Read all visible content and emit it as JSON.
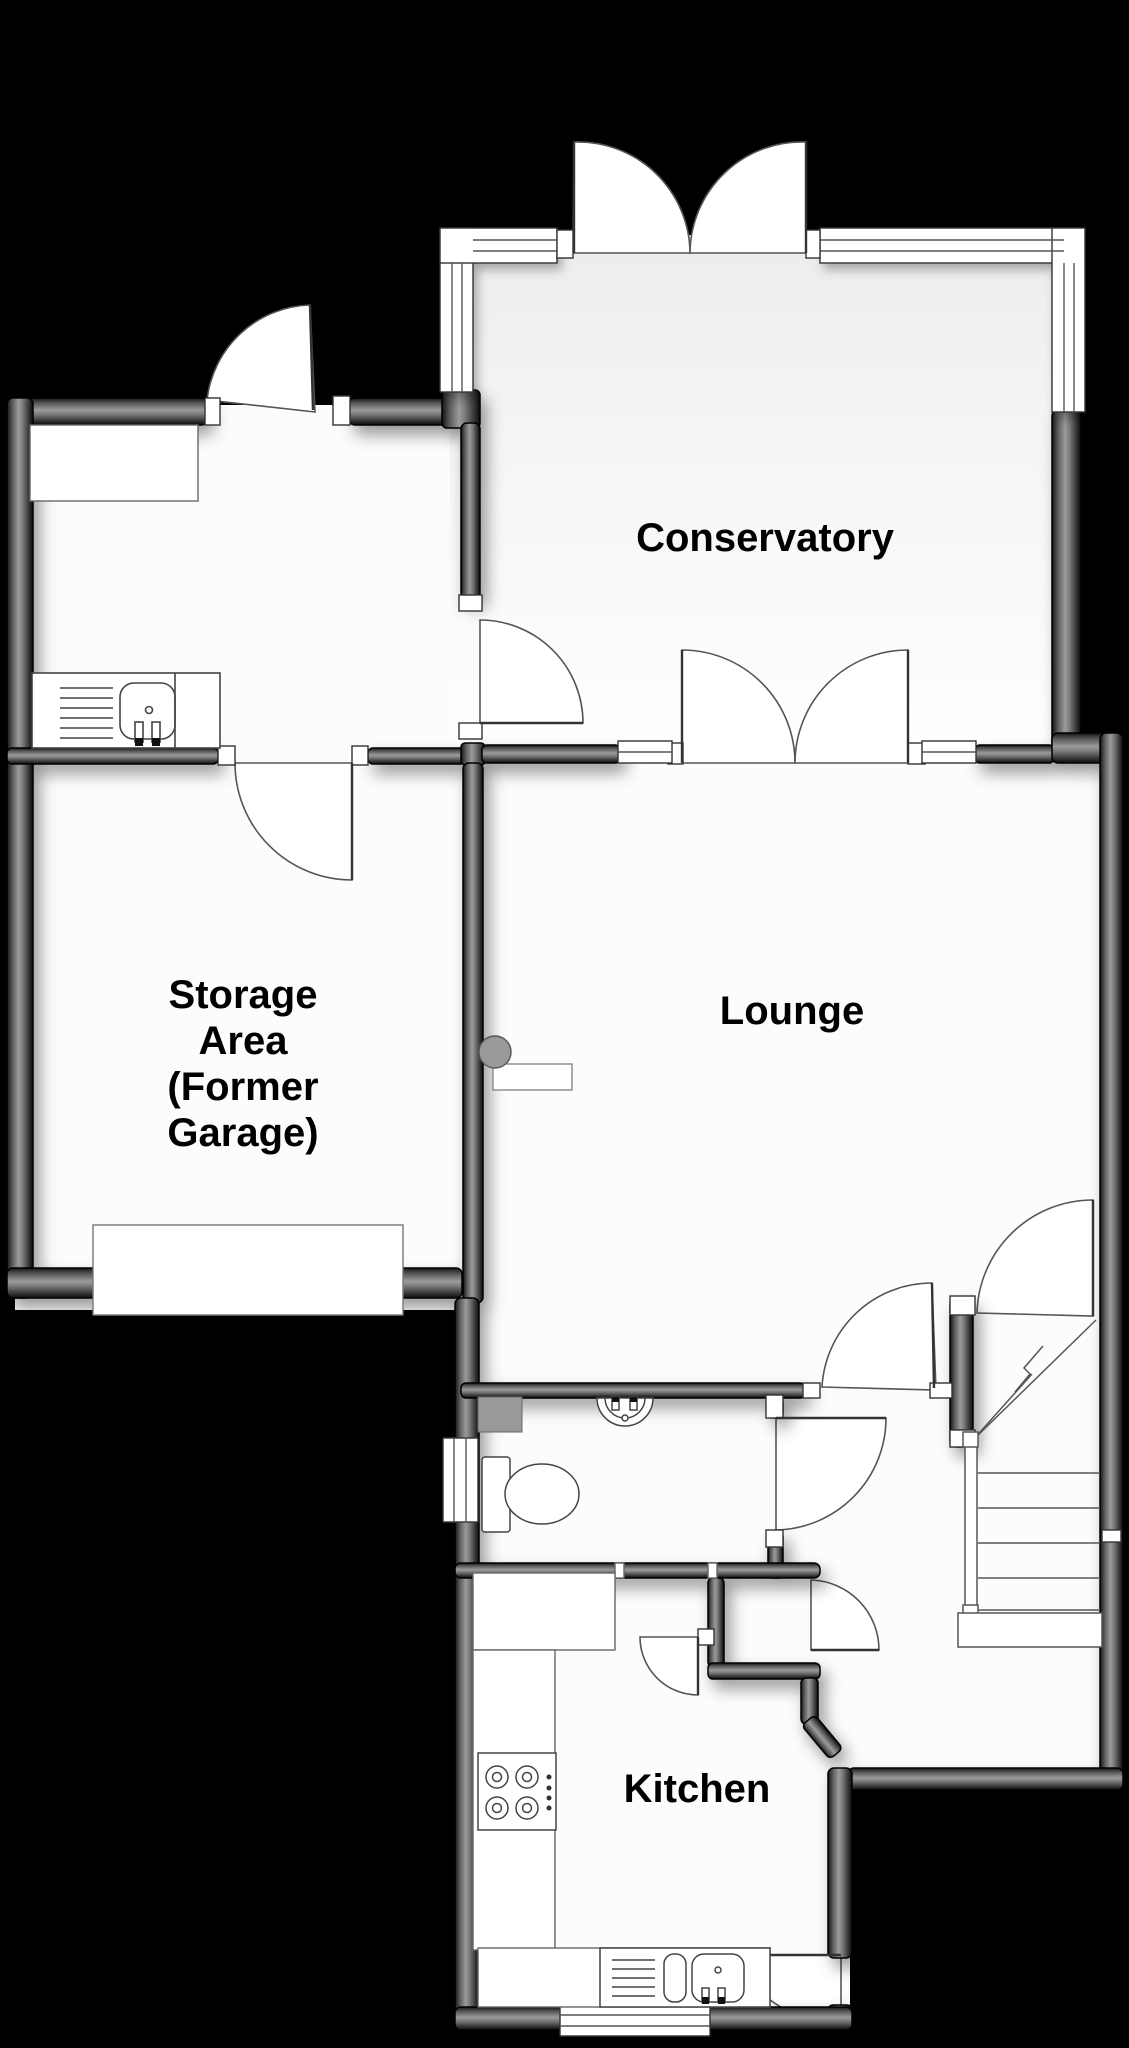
{
  "floorplan": {
    "type": "ground-floor-plan",
    "colors": {
      "background": "#000000",
      "wall": "#5f5f5f",
      "floor": "#fcfcfc",
      "label_text": "#000000",
      "fixture_outline": "#444444"
    },
    "rooms": {
      "conservatory": {
        "label": "Conservatory"
      },
      "storage": {
        "label_lines": [
          "Storage",
          "Area",
          "(Former",
          "Garage)"
        ]
      },
      "lounge": {
        "label": "Lounge"
      },
      "kitchen": {
        "label": "Kitchen"
      }
    }
  }
}
